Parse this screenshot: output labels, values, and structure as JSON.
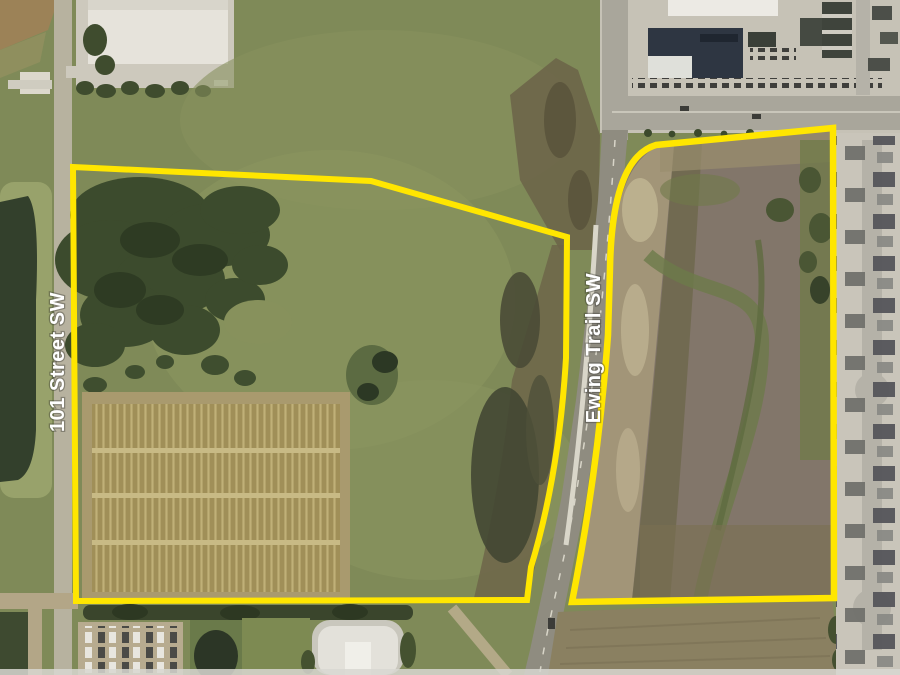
{
  "map": {
    "streets": {
      "west": {
        "label": "101 Street SW"
      },
      "east": {
        "label": "Ewing Trail SW"
      }
    },
    "annotation": {
      "boundary_color": "#FFE600",
      "label_text_color": "#FFFFFF"
    }
  }
}
